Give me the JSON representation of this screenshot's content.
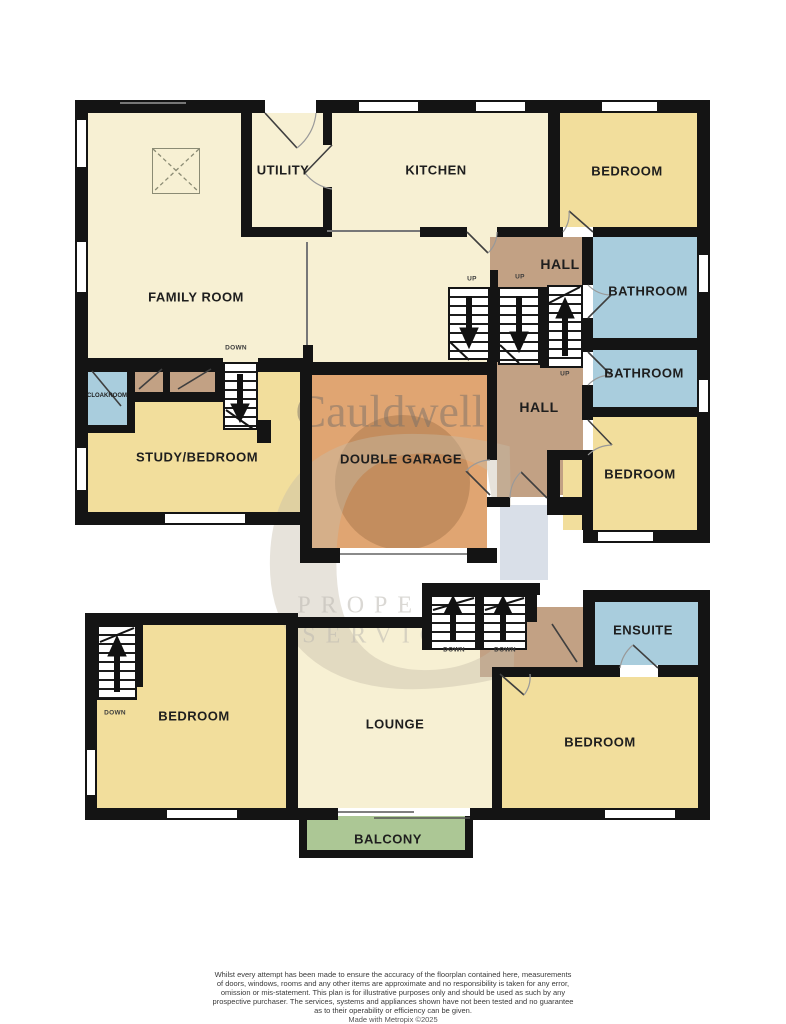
{
  "first_floor": {
    "rooms": {
      "family_room": "FAMILY ROOM",
      "utility": "UTILITY",
      "kitchen": "KITCHEN",
      "bedroom_top": "BEDROOM",
      "hall_upper": "HALL",
      "bathroom_1": "BATHROOM",
      "bathroom_2": "BATHROOM",
      "bedroom_right": "BEDROOM",
      "study_bedroom": "STUDY/BEDROOM",
      "double_garage": "DOUBLE GARAGE",
      "hall_main": "HALL",
      "cloakroom": "CLOAKROOM"
    }
  },
  "ground_floor": {
    "rooms": {
      "bedroom_left": "BEDROOM",
      "lounge": "LOUNGE",
      "bedroom_right": "BEDROOM",
      "ensuite": "ENSUITE",
      "balcony": "BALCONY"
    }
  },
  "labels": {
    "up": "UP",
    "down": "DOWN"
  },
  "watermark": {
    "brand": "Cauldwell",
    "word1": "PROPERTY",
    "word2": "SERVICES",
    "monogram": "C"
  },
  "footer": {
    "lines": [
      "Whilst every attempt has been made to ensure the accuracy of the floorplan contained here, measurements",
      "of doors, windows, rooms and any other items are approximate and no responsibility is taken for any error,",
      "omission or mis-statement. This plan is for illustrative purposes only and should be used as such by any",
      "prospective purchaser. The services, systems and appliances shown have not been tested and no guarantee",
      "as to their operability or efficiency can be given."
    ],
    "credit": "Made with Metropix ©2025"
  },
  "colors": {
    "wall": "#141414",
    "cream": "#F7F0D3",
    "yellow": "#F2DE9C",
    "blue": "#A9CDDD",
    "tan": "#C2A184",
    "orange": "#E0A572",
    "green": "#ACC795",
    "porch": "#D9DFE8",
    "ink": "#1E1E1E"
  }
}
